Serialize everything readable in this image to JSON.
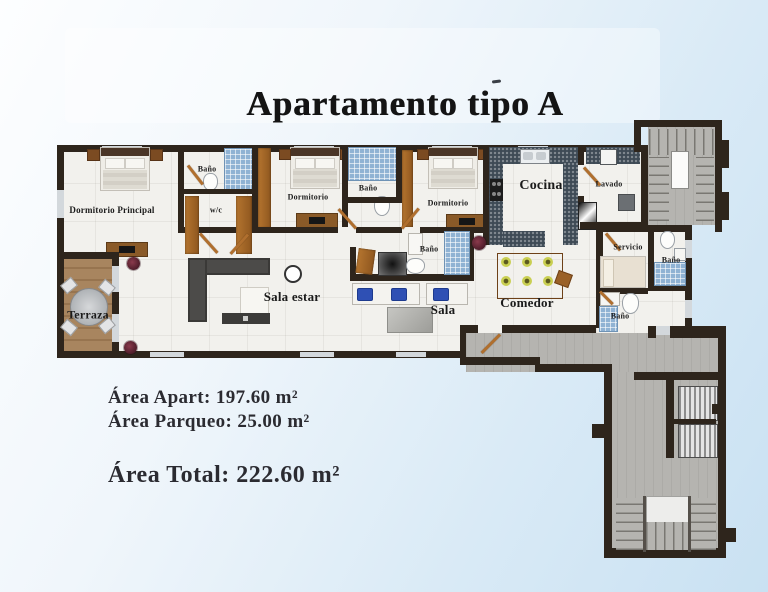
{
  "title": "Apartamento tipo A",
  "plan": {
    "rooms": [
      {
        "id": "dormitorio-principal",
        "label": "Dormitorio Principal",
        "x": 112,
        "y": 210,
        "fs": 9
      },
      {
        "id": "bano-principal",
        "label": "Baño",
        "x": 207,
        "y": 169,
        "fs": 8
      },
      {
        "id": "walk-in-closet",
        "label": "w/c",
        "x": 216,
        "y": 210,
        "fs": 8
      },
      {
        "id": "dormitorio-2",
        "label": "Dormitorio",
        "x": 308,
        "y": 197,
        "fs": 8
      },
      {
        "id": "bano-2",
        "label": "Baño",
        "x": 368,
        "y": 188,
        "fs": 8
      },
      {
        "id": "dormitorio-3",
        "label": "Dormitorio",
        "x": 448,
        "y": 203,
        "fs": 8
      },
      {
        "id": "bano-3",
        "label": "Baño",
        "x": 429,
        "y": 249,
        "fs": 8
      },
      {
        "id": "cocina",
        "label": "Cocina",
        "x": 541,
        "y": 186,
        "fs": 14
      },
      {
        "id": "lavado",
        "label": "Lavado",
        "x": 609,
        "y": 184,
        "fs": 8
      },
      {
        "id": "servicio",
        "label": "Servicio",
        "x": 628,
        "y": 247,
        "fs": 8
      },
      {
        "id": "bano-servicio",
        "label": "Baño",
        "x": 671,
        "y": 260,
        "fs": 8
      },
      {
        "id": "bano-4",
        "label": "Baño",
        "x": 620,
        "y": 316,
        "fs": 8
      },
      {
        "id": "comedor",
        "label": "Comedor",
        "x": 527,
        "y": 303,
        "fs": 13
      },
      {
        "id": "sala",
        "label": "Sala",
        "x": 443,
        "y": 310,
        "fs": 13
      },
      {
        "id": "sala-estar",
        "label": "Sala estar",
        "x": 292,
        "y": 297,
        "fs": 13
      },
      {
        "id": "terraza",
        "label": "Terraza",
        "x": 88,
        "y": 315,
        "fs": 12
      }
    ]
  },
  "areas": {
    "apart": "Área Apart: 197.60 m²",
    "parqueo": "Área Parqueo: 25.00 m²",
    "total": "Área Total: 222.60 m²"
  },
  "colors": {
    "wall": "#2e251c",
    "background_blue": "#c9e1f2",
    "floor": "#f2f1ed",
    "terrace_wood": "#a8855f",
    "bath_tile": "#8fb2d3",
    "kitchen_counter": "#3e4a55",
    "door_wood": "#b06f2e",
    "concrete": "#b5b4b0"
  }
}
